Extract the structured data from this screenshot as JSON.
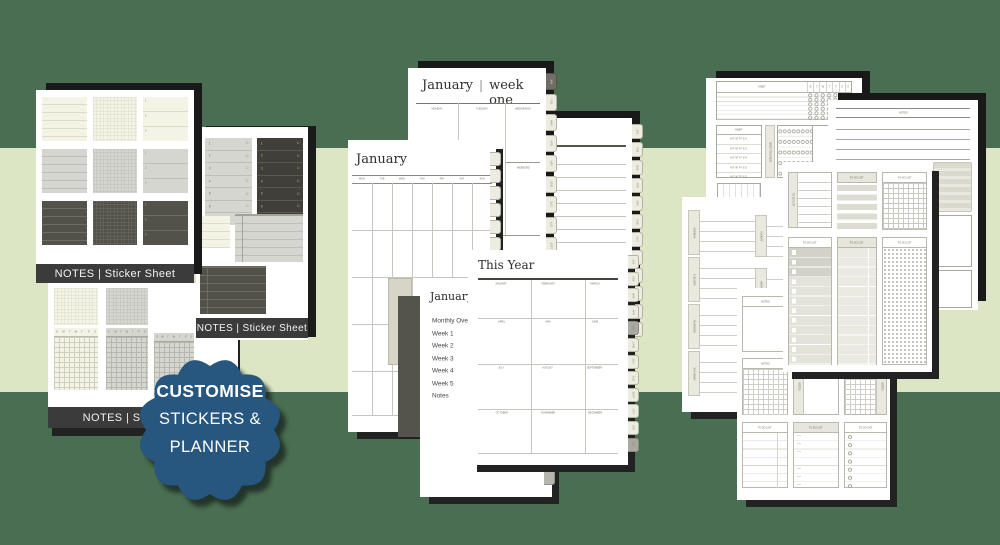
{
  "background": {
    "dark_green": "#4a6e51",
    "light_green": "#dce6c4"
  },
  "badge": {
    "color": "#27567f",
    "line1": "CUSTOMISE",
    "line2": "STICKERS &",
    "line3": "PLANNER"
  },
  "sticker_sheet": {
    "bar_label": "NOTES | Sticker Sheet",
    "list_numbers": [
      "1",
      "2",
      "3"
    ],
    "checklist_numbers": [
      "1",
      "2",
      "3",
      "4",
      "5",
      "6",
      "7"
    ],
    "week_letters": [
      "S",
      "M",
      "T",
      "W",
      "T",
      "F",
      "S"
    ]
  },
  "weekly_page": {
    "month": "January",
    "separator": "|",
    "week": "week one",
    "day_columns": [
      "MONDAY",
      "TUESDAY",
      "WEDNESDAY"
    ],
    "weekend": "WEEKEND",
    "month_tabs": [
      "JAN",
      "FEB",
      "MAR",
      "APR",
      "MAY",
      "JUNE",
      "JULY",
      "AUG",
      "SEPT",
      "OCT",
      "NOV",
      "DEC"
    ]
  },
  "monthly_page": {
    "title": "January",
    "weekdays": [
      "MON",
      "TUE",
      "WED",
      "THU",
      "FRI",
      "SAT",
      "SUN"
    ]
  },
  "year_page": {
    "title": "This Year",
    "months": [
      "JANUARY",
      "FEBRUARY",
      "MARCH",
      "APRIL",
      "MAY",
      "JUNE",
      "JULY",
      "AUGUST",
      "SEPTEMBER",
      "OCTOBER",
      "NOVEMBER",
      "DECEMBER"
    ]
  },
  "contents_page": {
    "title": "January",
    "items": [
      "Monthly Overview",
      "Week 1",
      "Week 2",
      "Week 3",
      "Week 4",
      "Week 5",
      "Notes"
    ]
  },
  "habit_page": {
    "habit": "HABIT",
    "tracker": "HABIT TRACKER",
    "day_letters": [
      "M",
      "T",
      "W",
      "T",
      "F",
      "S",
      "S"
    ],
    "day_letters_row": "M T W T F S S"
  },
  "notes": {
    "label": "NOTES"
  },
  "todo": {
    "label": "TO DO LIST"
  },
  "weekly_spread": {
    "left_days": [
      "MONDAY",
      "TUESDAY",
      "THURSDAY",
      "SATURDAY"
    ],
    "right_days": [
      "SUNDAY",
      "WEDNESDAY"
    ]
  }
}
